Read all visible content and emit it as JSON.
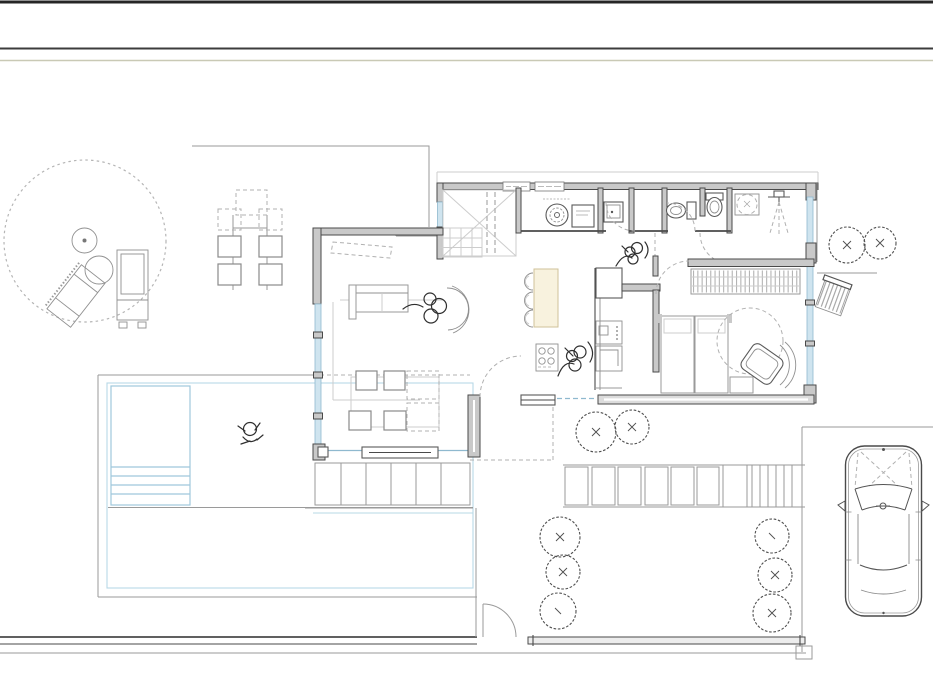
{
  "canvas": {
    "width": 933,
    "height": 700,
    "background": "#ffffff"
  },
  "header": {
    "top_border_color": "#262626",
    "divider_color": "#3c3c3c",
    "accent_rule_color": "#c9c9b5"
  },
  "plan": {
    "type": "architectural-floor-plan",
    "palette": {
      "bg": "#ffffff",
      "wall": "#4a4a4a",
      "wall_fill": "#c9c9c9",
      "line": "#9a9a9a",
      "faint": "#cdcdcd",
      "dash": "#b0b0b0",
      "glazing_fill": "#cfe4ef",
      "glazing_edge": "#8fb9cf",
      "water": "#9fc8dc",
      "deck": "#b7d8e6",
      "island_fill": "#f8f2de",
      "island_edge": "#cfc29a",
      "sketch": "#2f2f2f",
      "hatch": "#b4b4b4",
      "tree": "#4f4f4f"
    },
    "rooms": [
      "entry-closet",
      "laundry-room",
      "utility-wc",
      "wc-1",
      "wc-2",
      "bathroom",
      "hallway",
      "kitchen",
      "living-dining-room",
      "bedroom"
    ],
    "outdoor_areas": [
      "patio-circle",
      "outdoor-dining",
      "pool-terrace",
      "garden",
      "paved-path",
      "driveway"
    ],
    "features": [
      "patio-umbrella",
      "patio-table",
      "sun-lounger",
      "sun-lounger",
      "dining-table-outdoor",
      "washing-machine",
      "dryer",
      "laundry-basin",
      "toilet",
      "toilet",
      "washbasin",
      "shower",
      "kitchen-island",
      "bar-stools",
      "cooktop",
      "fridge",
      "oven",
      "sink-unit",
      "sofa",
      "rug",
      "potted-plant",
      "dining-table",
      "dining-chairs",
      "double-bed",
      "nightstand",
      "hanging-chair",
      "wardrobe",
      "swimming-pool",
      "pool-steps",
      "swimmer-figure",
      "garden-gate",
      "car-top-view",
      "rain-barrel"
    ],
    "tree_count": 10
  }
}
